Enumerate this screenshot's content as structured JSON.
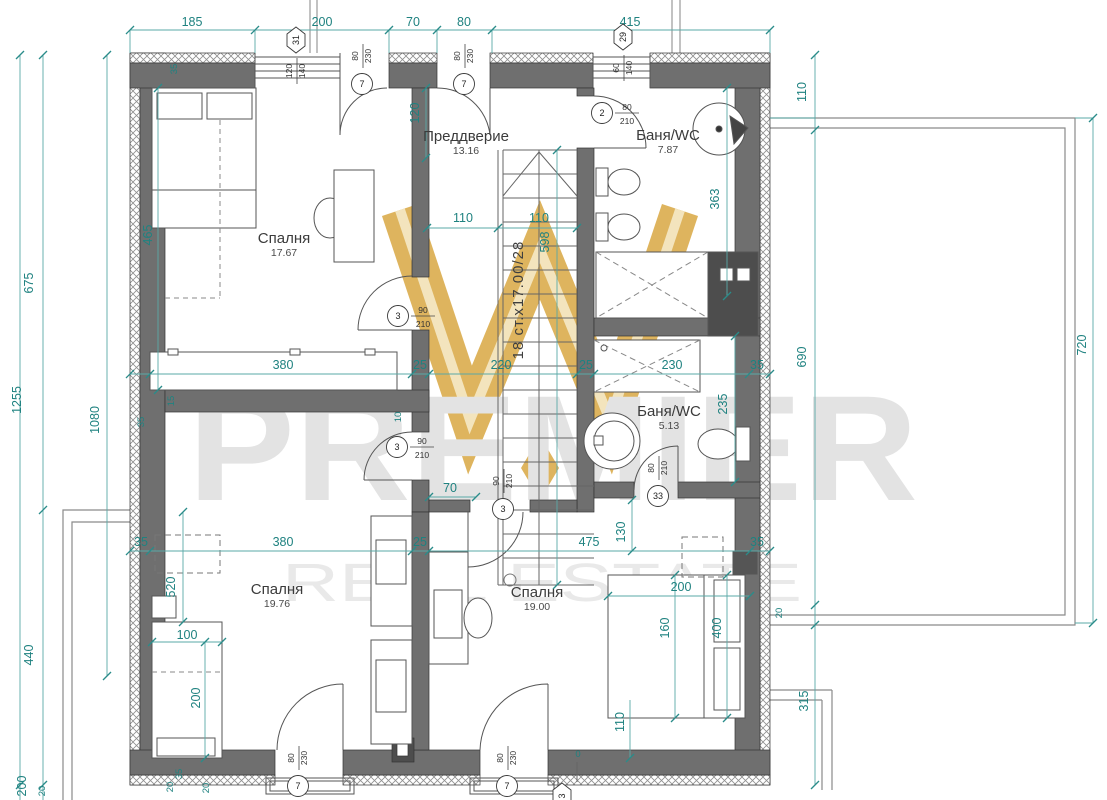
{
  "watermark": {
    "brand": "PREMIER",
    "tagline": "REAL ESTATE",
    "gold": "#d9a843",
    "gold_light": "#f2e0b2",
    "gray": "#e3e3e3"
  },
  "colors": {
    "dim_teal": "#1f8280",
    "dim_line": "#5aa9a7",
    "wall_gray": "#6f6f6f",
    "wall_dark": "#4d4d4d"
  },
  "rooms": [
    {
      "name": "Спалня",
      "area": "17.67",
      "x": 284,
      "y": 243
    },
    {
      "name": "Преддверие",
      "area": "13.16",
      "x": 466,
      "y": 141
    },
    {
      "name": "Баня/WC",
      "area": "7.87",
      "x": 668,
      "y": 140
    },
    {
      "name": "Баня/WC",
      "area": "5.13",
      "x": 669,
      "y": 416
    },
    {
      "name": "Спалня",
      "area": "19.76",
      "x": 277,
      "y": 594
    },
    {
      "name": "Спалня",
      "area": "19.00",
      "x": 537,
      "y": 597
    }
  ],
  "stairs_label": "18 ст.х17.00/28",
  "dims_h": [
    {
      "t": "185",
      "x": 192,
      "y": 26
    },
    {
      "t": "200",
      "x": 322,
      "y": 26
    },
    {
      "t": "70",
      "x": 413,
      "y": 26
    },
    {
      "t": "80",
      "x": 464,
      "y": 26
    },
    {
      "t": "415",
      "x": 630,
      "y": 26
    },
    {
      "t": "110",
      "x": 463,
      "y": 222
    },
    {
      "t": "110",
      "x": 539,
      "y": 222
    },
    {
      "t": "380",
      "x": 283,
      "y": 369
    },
    {
      "t": "25",
      "x": 420,
      "y": 369
    },
    {
      "t": "220",
      "x": 501,
      "y": 369
    },
    {
      "t": "25",
      "x": 586,
      "y": 369
    },
    {
      "t": "230",
      "x": 672,
      "y": 369
    },
    {
      "t": "35",
      "x": 757,
      "y": 369
    },
    {
      "t": "35",
      "x": 141,
      "y": 546
    },
    {
      "t": "380",
      "x": 283,
      "y": 546
    },
    {
      "t": "25",
      "x": 420,
      "y": 546
    },
    {
      "t": "475",
      "x": 589,
      "y": 546
    },
    {
      "t": "35",
      "x": 757,
      "y": 546
    },
    {
      "t": "70",
      "x": 450,
      "y": 492
    },
    {
      "t": "200",
      "x": 681,
      "y": 591
    },
    {
      "t": "100",
      "x": 187,
      "y": 639
    },
    {
      "t": "0",
      "x": 578,
      "y": 757,
      "s": 1
    }
  ],
  "dims_v": [
    {
      "t": "1255",
      "x": 21,
      "y": 400
    },
    {
      "t": "675",
      "x": 33,
      "y": 283
    },
    {
      "t": "1080",
      "x": 99,
      "y": 420
    },
    {
      "t": "440",
      "x": 33,
      "y": 655
    },
    {
      "t": "465",
      "x": 152,
      "y": 235
    },
    {
      "t": "35",
      "x": 177,
      "y": 69,
      "s": 1
    },
    {
      "t": "120",
      "x": 419,
      "y": 113
    },
    {
      "t": "598",
      "x": 549,
      "y": 242
    },
    {
      "t": "363",
      "x": 719,
      "y": 199
    },
    {
      "t": "235",
      "x": 727,
      "y": 404
    },
    {
      "t": "130",
      "x": 625,
      "y": 532
    },
    {
      "t": "110",
      "x": 806,
      "y": 92
    },
    {
      "t": "690",
      "x": 806,
      "y": 357
    },
    {
      "t": "20",
      "x": 782,
      "y": 613,
      "s": 1
    },
    {
      "t": "315",
      "x": 808,
      "y": 701
    },
    {
      "t": "720",
      "x": 1086,
      "y": 345
    },
    {
      "t": "15",
      "x": 174,
      "y": 401,
      "s": 1
    },
    {
      "t": "10",
      "x": 401,
      "y": 417,
      "s": 1
    },
    {
      "t": "35",
      "x": 144,
      "y": 422,
      "s": 1
    },
    {
      "t": "520",
      "x": 175,
      "y": 587
    },
    {
      "t": "200",
      "x": 200,
      "y": 698
    },
    {
      "t": "160",
      "x": 669,
      "y": 628
    },
    {
      "t": "400",
      "x": 721,
      "y": 628
    },
    {
      "t": "110",
      "x": 624,
      "y": 722
    },
    {
      "t": "200",
      "x": 26,
      "y": 786
    },
    {
      "t": "20",
      "x": 45,
      "y": 791,
      "s": 1
    },
    {
      "t": "20",
      "x": 173,
      "y": 787,
      "s": 1
    },
    {
      "t": "35",
      "x": 182,
      "y": 774,
      "s": 1
    },
    {
      "t": "20",
      "x": 209,
      "y": 788,
      "s": 1
    }
  ],
  "door_markers": [
    {
      "n": "7",
      "a": "80",
      "b": "230",
      "x": 362,
      "y": 84,
      "o": "v"
    },
    {
      "n": "7",
      "a": "80",
      "b": "230",
      "x": 464,
      "y": 84,
      "o": "v"
    },
    {
      "n": "2",
      "a": "80",
      "b": "210",
      "x": 602,
      "y": 113,
      "o": "h"
    },
    {
      "n": "3",
      "a": "90",
      "b": "210",
      "x": 398,
      "y": 316,
      "o": "h"
    },
    {
      "n": "3",
      "a": "90",
      "b": "210",
      "x": 397,
      "y": 447,
      "o": "h"
    },
    {
      "n": "3",
      "a": "90",
      "b": "210",
      "x": 503,
      "y": 509,
      "o": "v"
    },
    {
      "n": "33",
      "a": "80",
      "b": "210",
      "x": 658,
      "y": 496,
      "o": "v"
    },
    {
      "n": "7",
      "a": "80",
      "b": "230",
      "x": 298,
      "y": 786,
      "o": "v"
    },
    {
      "n": "7",
      "a": "80",
      "b": "230",
      "x": 507,
      "y": 786,
      "o": "v"
    }
  ],
  "window_markers": [
    {
      "n": "31",
      "a": "120",
      "b": "140",
      "x": 296,
      "y": 40
    },
    {
      "n": "29",
      "a": "60",
      "b": "140",
      "x": 623,
      "y": 37
    },
    {
      "n": "3",
      "a": "",
      "b": "",
      "x": 562,
      "y": 796
    }
  ],
  "ticks": [
    [
      130,
      30
    ],
    [
      255,
      30
    ],
    [
      389,
      30
    ],
    [
      437,
      30
    ],
    [
      492,
      30
    ],
    [
      770,
      30
    ],
    [
      130,
      374
    ],
    [
      150,
      374
    ],
    [
      412,
      374
    ],
    [
      429,
      374
    ],
    [
      577,
      374
    ],
    [
      594,
      374
    ],
    [
      749,
      374
    ],
    [
      770,
      374
    ],
    [
      130,
      551
    ],
    [
      150,
      551
    ],
    [
      412,
      551
    ],
    [
      429,
      551
    ],
    [
      750,
      551
    ],
    [
      770,
      551
    ],
    [
      427,
      228
    ],
    [
      498,
      228
    ],
    [
      577,
      228
    ],
    [
      557,
      150
    ],
    [
      557,
      585
    ],
    [
      426,
      88
    ],
    [
      426,
      158
    ],
    [
      20,
      55
    ],
    [
      43,
      55
    ],
    [
      43,
      510
    ],
    [
      43,
      785
    ],
    [
      20,
      785
    ],
    [
      107,
      55
    ],
    [
      107,
      676
    ],
    [
      815,
      55
    ],
    [
      815,
      130
    ],
    [
      815,
      605
    ],
    [
      815,
      625
    ],
    [
      815,
      785
    ],
    [
      1093,
      118
    ],
    [
      1093,
      623
    ],
    [
      735,
      336
    ],
    [
      735,
      482
    ],
    [
      727,
      88
    ],
    [
      727,
      296
    ],
    [
      632,
      500
    ],
    [
      632,
      551
    ],
    [
      630,
      758
    ],
    [
      429,
      497
    ],
    [
      476,
      497
    ],
    [
      152,
      642
    ],
    [
      222,
      642
    ],
    [
      205,
      642
    ],
    [
      205,
      758
    ],
    [
      608,
      596
    ],
    [
      750,
      596
    ],
    [
      675,
      575
    ],
    [
      675,
      718
    ],
    [
      727,
      575
    ],
    [
      727,
      718
    ],
    [
      183,
      512
    ],
    [
      183,
      622
    ],
    [
      158,
      88
    ],
    [
      158,
      390
    ]
  ]
}
